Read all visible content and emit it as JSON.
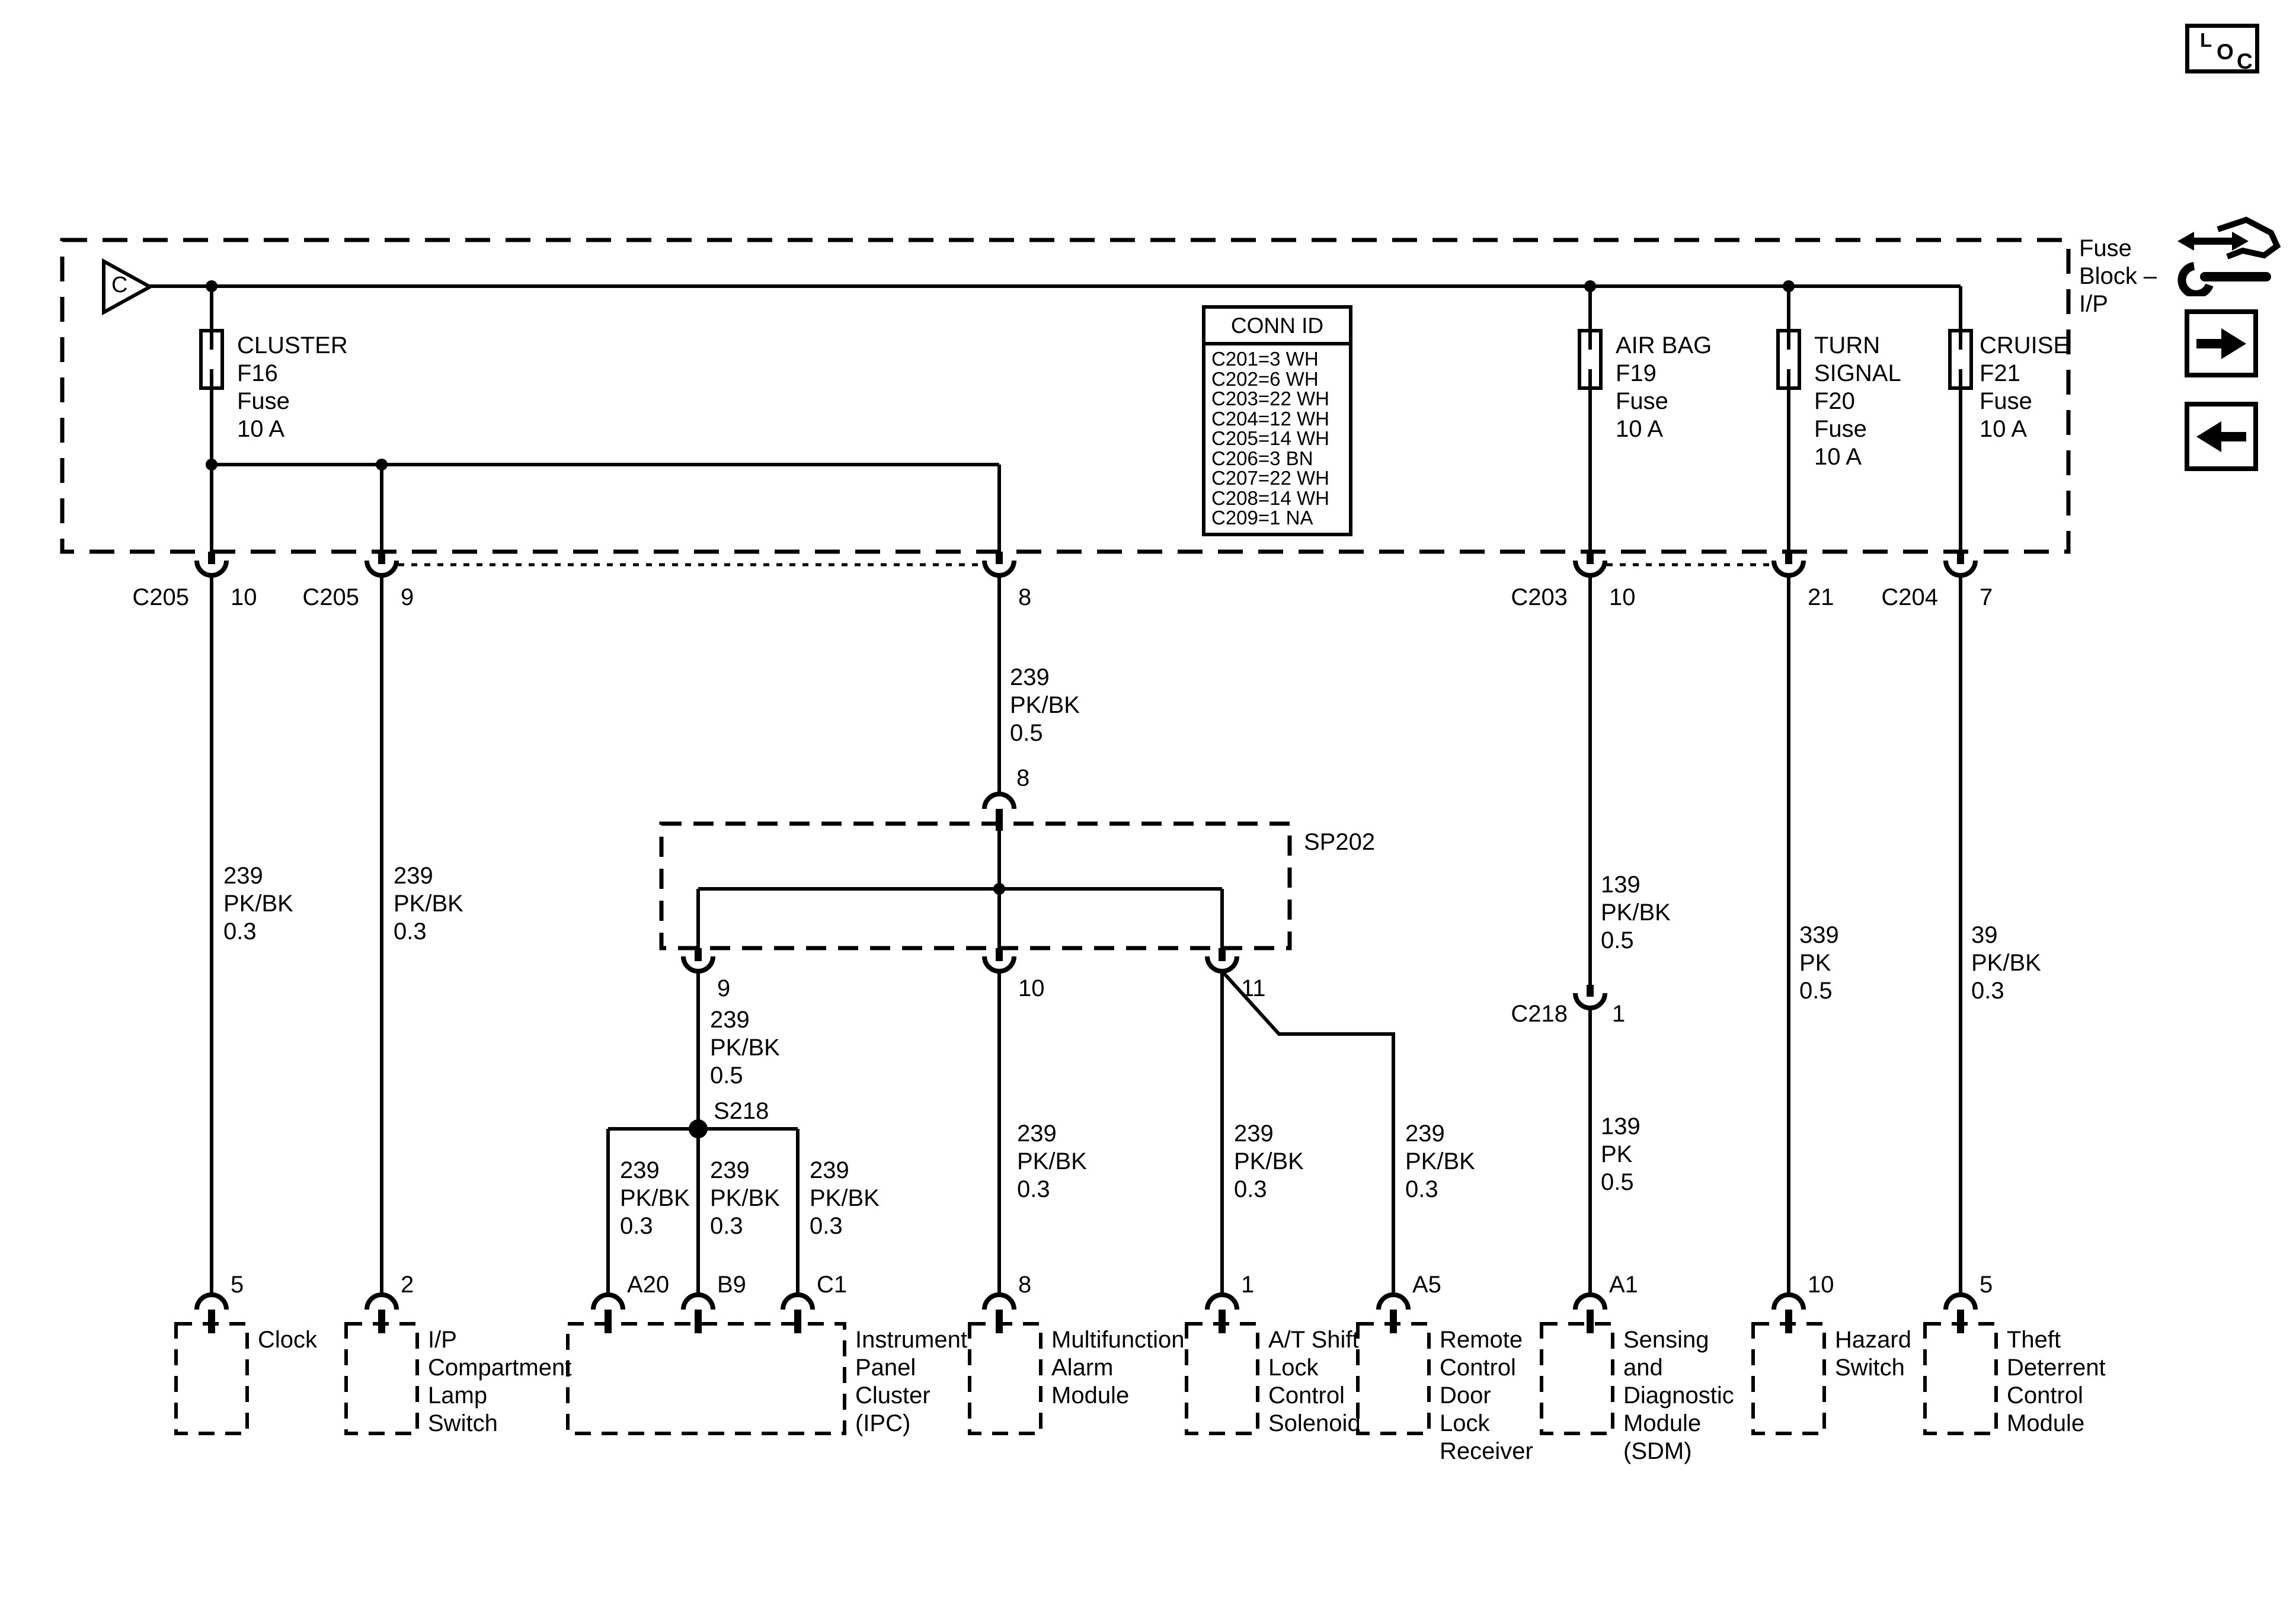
{
  "fuse_block": {
    "label": "Fuse\nBlock –\nI/P",
    "entry_marker": "C",
    "fuses": {
      "f16": "CLUSTER\nF16\nFuse\n10 A",
      "f19": "AIR BAG\nF19\nFuse\n10 A",
      "f20": "TURN\nSIGNAL\nF20\nFuse\n10 A",
      "f21": "CRUISE\nF21\nFuse\n10 A"
    }
  },
  "conn_id": {
    "header": "CONN ID",
    "rows": [
      "C201=3 WH",
      "C202=6 WH",
      "C203=22 WH",
      "C204=12 WH",
      "C205=14 WH",
      "C206=3 BN",
      "C207=22 WH",
      "C208=14 WH",
      "C209=1 NA"
    ]
  },
  "connectors": {
    "c205_10": {
      "name": "C205",
      "pin": "10"
    },
    "c205_9": {
      "name": "C205",
      "pin": "9"
    },
    "pin8_out": "8",
    "pin8_in": "8",
    "c203_10": {
      "name": "C203",
      "pin": "10"
    },
    "pin21": "21",
    "c204_7": {
      "name": "C204",
      "pin": "7"
    },
    "c218_1": {
      "name": "C218",
      "pin": "1"
    }
  },
  "splices": {
    "sp202": {
      "label": "SP202",
      "pins": [
        "9",
        "10",
        "11"
      ]
    },
    "s218": "S218"
  },
  "wires": {
    "clock": "239\nPK/BK\n0.3",
    "ip_lamp": "239\nPK/BK\n0.3",
    "sp202_feed": "239\nPK/BK\n0.5",
    "s218_feed": "239\nPK/BK\n0.5",
    "ipc_a20": "239\nPK/BK\n0.3",
    "ipc_b9": "239\nPK/BK\n0.3",
    "ipc_c1": "239\nPK/BK\n0.3",
    "multifunction": "239\nPK/BK\n0.3",
    "at_shift": "239\nPK/BK\n0.3",
    "remote": "239\nPK/BK\n0.3",
    "sdm_upper": "139\nPK/BK\n0.5",
    "sdm_lower": "139\nPK\n0.5",
    "hazard": "339\nPK\n0.5",
    "theft": "39\nPK/BK\n0.3"
  },
  "modules": [
    {
      "label": "Clock",
      "pin": "5"
    },
    {
      "label": "I/P\nCompartment\nLamp\nSwitch",
      "pin": "2"
    },
    {
      "label": "Instrument\nPanel\nCluster\n(IPC)",
      "pins": [
        "A20",
        "B9",
        "C1"
      ]
    },
    {
      "label": "Multifunction\nAlarm\nModule",
      "pin": "8"
    },
    {
      "label": "A/T Shift\nLock\nControl\nSolenoid",
      "pin": "1"
    },
    {
      "label": "Remote\nControl\nDoor\nLock\nReceiver",
      "pin": "A5"
    },
    {
      "label": "Sensing\nand\nDiagnostic\nModule\n(SDM)",
      "pin": "A1"
    },
    {
      "label": "Hazard\nSwitch",
      "pin": "10"
    },
    {
      "label": "Theft\nDeterrent\nControl\nModule",
      "pin": "5"
    }
  ],
  "nav": {
    "loc": {
      "l": "L",
      "o": "O",
      "c": "C"
    }
  }
}
